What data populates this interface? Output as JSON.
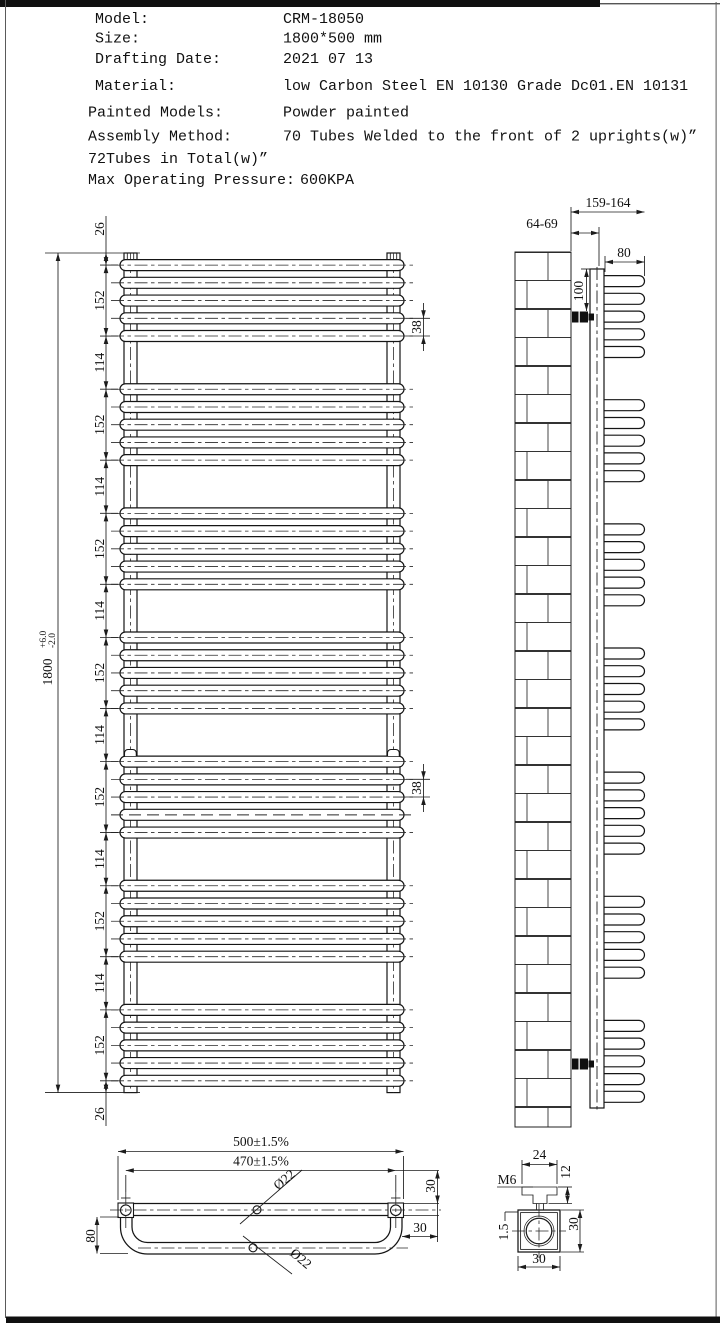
{
  "info": {
    "rows": [
      {
        "label": "Model:",
        "value": "CRM-18050"
      },
      {
        "label": "Size:",
        "value": "1800*500 mm"
      },
      {
        "label": "Drafting Date:",
        "value": "2021 07 13"
      },
      {
        "label": "Material:",
        "value": "low Carbon Steel  EN 10130 Grade Dc01.EN 10131"
      },
      {
        "label": "Painted Models:",
        "value": "Powder painted"
      },
      {
        "label": "Assembly Method:",
        "value": "70 Tubes Welded to the front of 2 uprights(w)”"
      },
      {
        "label": "72Tubes in Total(w)”",
        "value": ""
      },
      {
        "label": "Max Operating Pressure:",
        "value": "600KPA"
      }
    ]
  },
  "front_view": {
    "overall": {
      "value": "1800",
      "tol_plus": "+6.0",
      "tol_minus": "-2.0"
    },
    "chain": [
      "26",
      "152",
      "114",
      "152",
      "114",
      "152",
      "114",
      "152",
      "114",
      "152",
      "114",
      "152",
      "114",
      "152",
      "26"
    ],
    "tube_pitch_top": "38",
    "tube_pitch_mid": "38"
  },
  "side_view": {
    "wall_to_front": "159-164",
    "wall_to_upright": "64-69",
    "tube_depth": "80",
    "bracket_drop": "100"
  },
  "bottom_view": {
    "overall_width": "500±1.5%",
    "upright_centers": "470±1.5%",
    "tube_dia_top": "Ø22",
    "tube_dia_bottom": "Ø22",
    "loop_depth": "80",
    "offset_right_v": "30",
    "offset_right_h": "30"
  },
  "detail_view": {
    "plate_width": "24",
    "plate_height": "12",
    "thread": "M6",
    "wall_thickness": "1.5",
    "body_width": "30",
    "body_height": "30"
  }
}
